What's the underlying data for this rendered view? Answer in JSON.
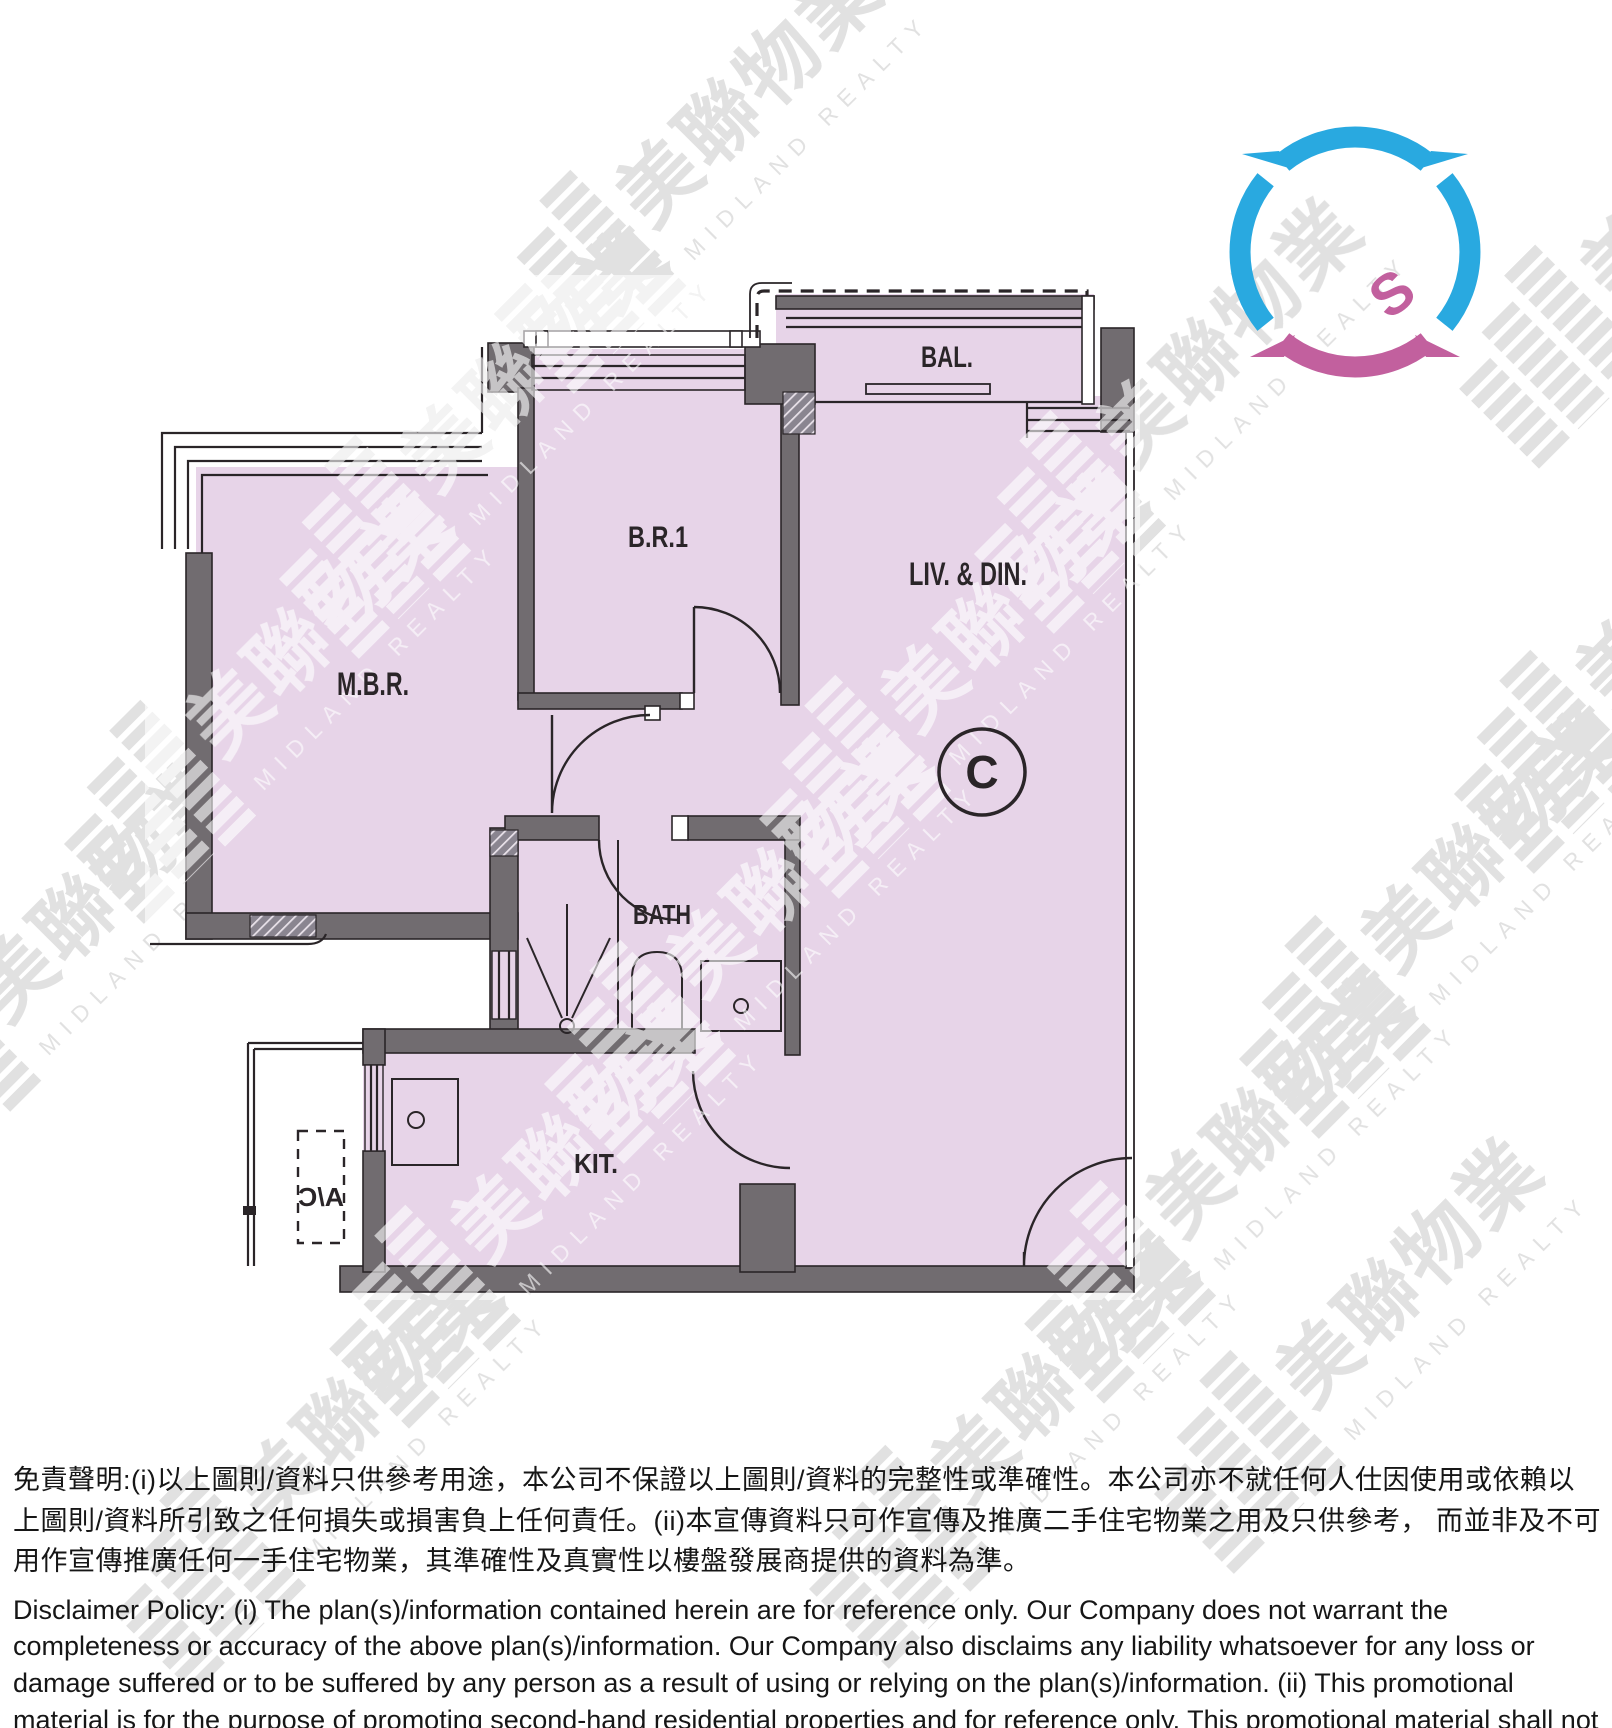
{
  "floor_plan": {
    "rooms": {
      "balcony": "BAL.",
      "bedroom1": "B.R.1",
      "living_dining": "LIV. & DIN.",
      "master_bedroom": "M.B.R.",
      "bathroom": "BATH",
      "kitchen": "KIT.",
      "ac_platform": "A/C",
      "unit": "C"
    },
    "colors": {
      "room_fill": "#e7d4e8",
      "wall": "#716c70",
      "line": "#2a2528"
    }
  },
  "compass": {
    "south_label": "S",
    "ring_color": "#29a9e0",
    "south_color": "#c2609e"
  },
  "watermark": {
    "chinese": "美聯物業",
    "english": "MIDLAND REALTY"
  },
  "disclaimer": {
    "chinese": "免責聲明:(i)以上圖則/資料只供參考用途，本公司不保證以上圖則/資料的完整性或準確性。本公司亦不就任何人仕因使用或依賴以上圖則/資料所引致之任何損失或損害負上任何責任。(ii)本宣傳資料只可作宣傳及推廣二手住宅物業之用及只供參考， 而並非及不可用作宣傳推廣任何一手住宅物業，其準確性及真實性以樓盤發展商提供的資料為準。",
    "english": "Disclaimer Policy: (i) The plan(s)/information contained herein are for reference only. Our Company does not warrant the completeness or accuracy of the above plan(s)/information. Our Company also disclaims any liability whatsoever for any loss or damage suffered or to be suffered by any person as a result of using or relying on the plan(s)/information. (ii) This promotional material is for the purpose of promoting second-hand residential properties and for reference only. This promotional material shall not be used for the purpose of promoting first-hand residential properties. The accuracy and truth of the information contained in this promotional material shall be subject to information provided by the developers."
  }
}
